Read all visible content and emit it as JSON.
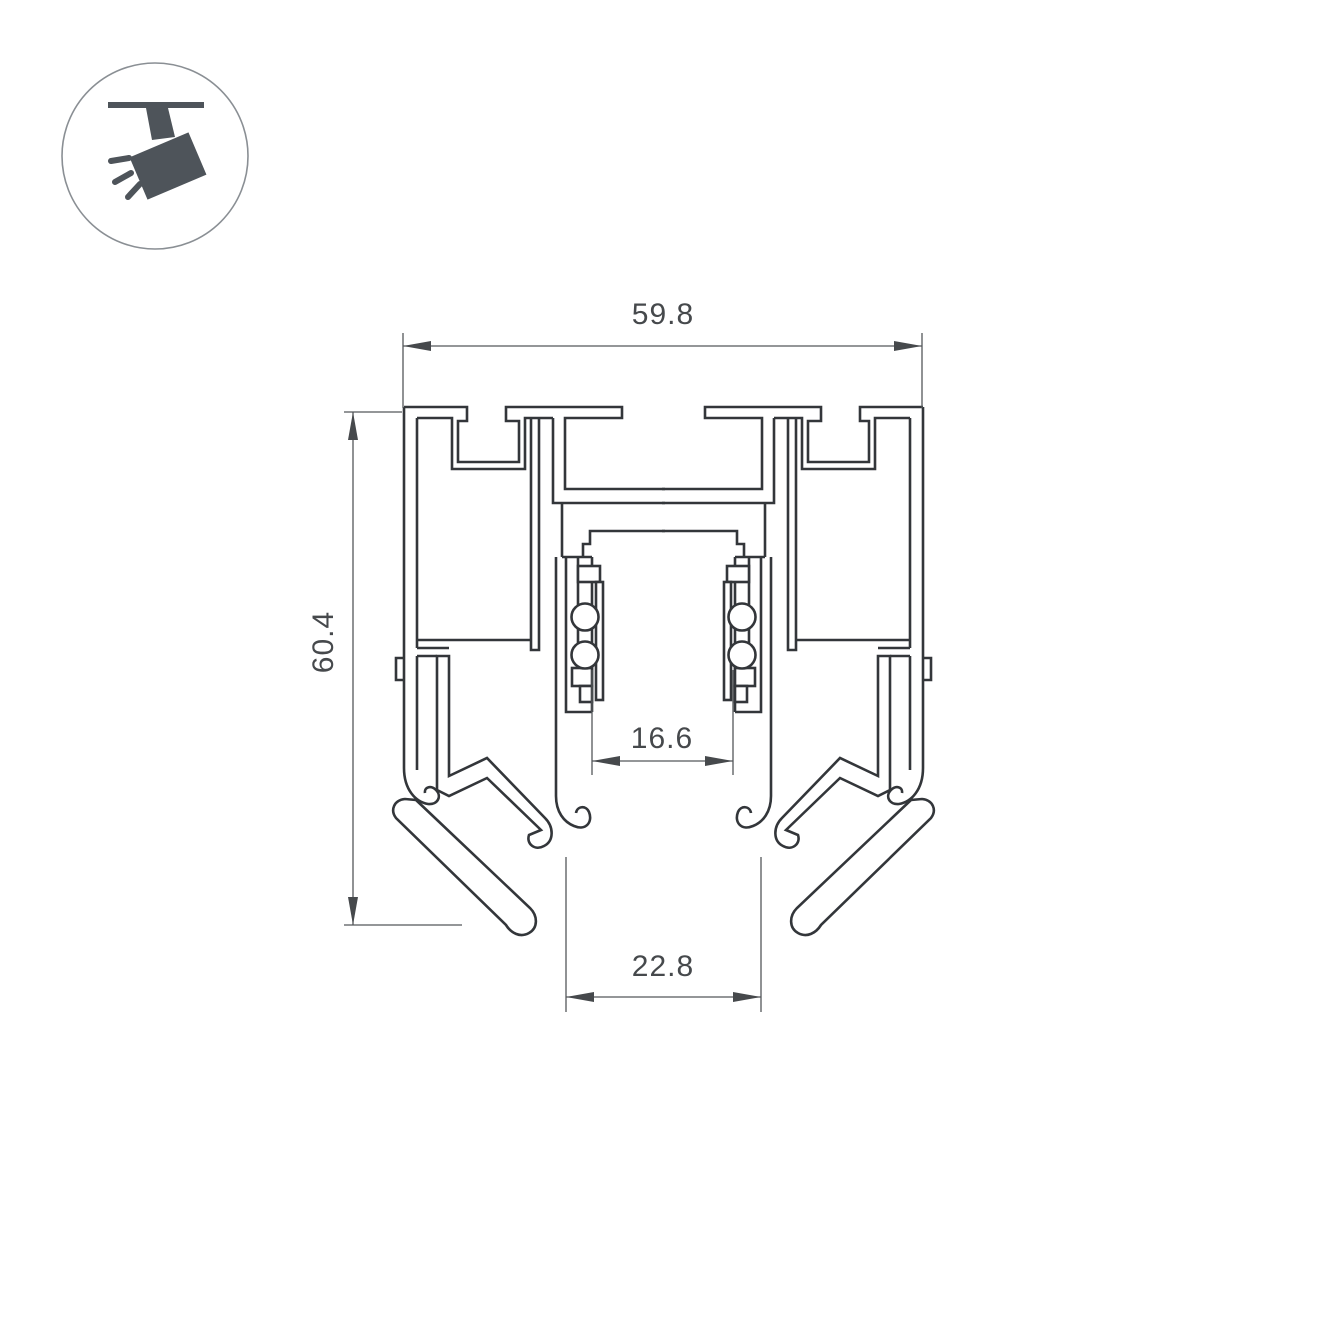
{
  "drawing": {
    "type": "profile-cross-section",
    "dimensions": {
      "top_width": "59.8",
      "left_height": "60.4",
      "inner_channel_width": "16.6",
      "bottom_opening_width": "22.8"
    },
    "icon": "ceiling-track-spotlight",
    "colors": {
      "background": "#ffffff",
      "profile_line": "#33363a",
      "dimension_line": "#55585b",
      "dimension_text": "#46494c",
      "icon_fill": "#4e545a",
      "icon_circle_border": "#8a8f94"
    }
  }
}
